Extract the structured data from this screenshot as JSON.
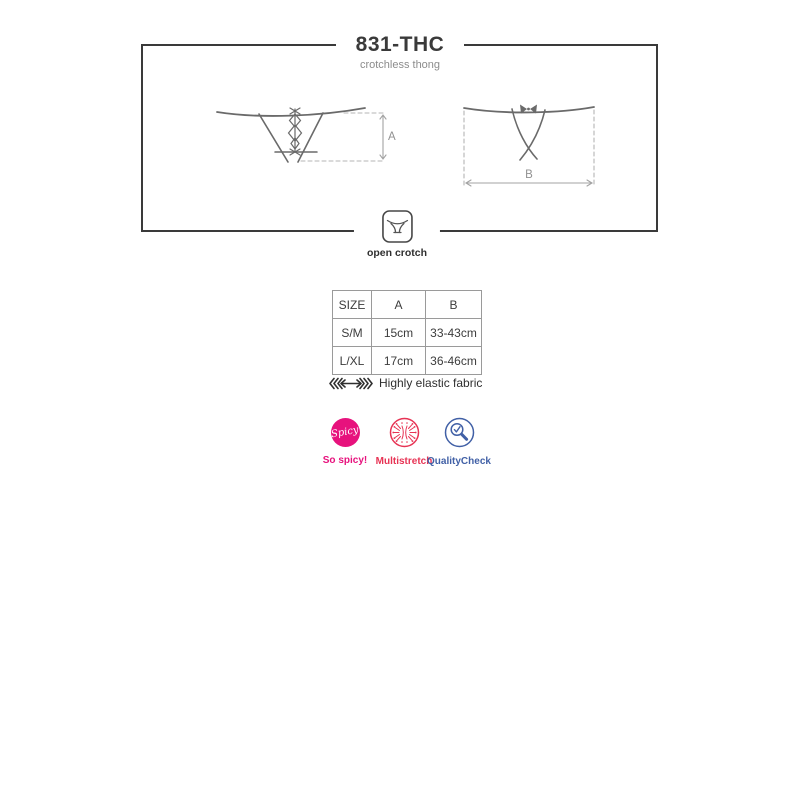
{
  "header": {
    "title": "831-THC",
    "subtitle": "crotchless thong"
  },
  "diagram": {
    "front_dimension_label": "A",
    "back_dimension_label": "B",
    "open_crotch_label": "open crotch"
  },
  "size_table": {
    "columns": [
      "SIZE",
      "A",
      "B"
    ],
    "rows": [
      [
        "S/M",
        "15cm",
        "33-43cm"
      ],
      [
        "L/XL",
        "17cm",
        "36-46cm"
      ]
    ]
  },
  "fabric_note": "Highly elastic fabric",
  "badges": {
    "spicy": {
      "icon_text": "Spicy",
      "label": "So spicy!",
      "color": "#e7127d"
    },
    "multistretch": {
      "label": "Multistretch",
      "color": "#e73354"
    },
    "quality_check": {
      "label": "QualityCheck",
      "color": "#4160a6"
    }
  },
  "colors": {
    "frame_border": "#3a3a3a",
    "diagram_stroke": "#6a6a6a",
    "dimension_line": "#b5b5b5",
    "table_border": "#9a9a9a",
    "text_dark": "#3a3a3a",
    "text_gray": "#8c8c8c"
  }
}
